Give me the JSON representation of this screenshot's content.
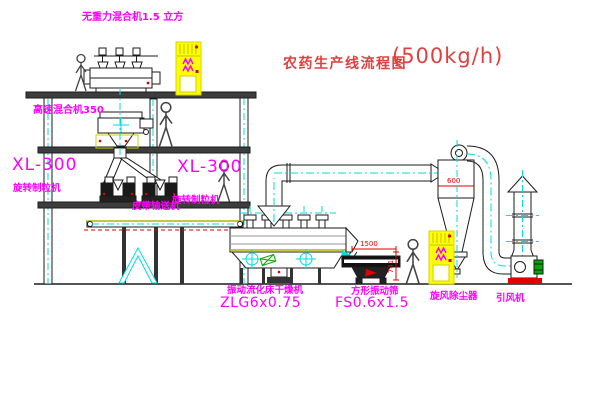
{
  "title": {
    "name": "农药生产线流程图",
    "capacity": "(500kg/h)"
  },
  "labels": {
    "top_mixer": "无重力混合机1.5 立方",
    "high_speed_mixer": "高速混合机350",
    "granulator_left_model": "XL-300",
    "granulator_left_name": "旋转制粒机",
    "granulator_right_model": "XL-300",
    "granulator_right_name": "旋转制粒机",
    "belt_conveyor": "皮带输送机",
    "dryer_name": "振动流化床干燥机",
    "dryer_model": "ZLG6x0.75",
    "sieve_name": "方形振动筛",
    "sieve_model": "FS0.6x1.5",
    "cyclone": "旋风除尘器",
    "fan": "引风机"
  },
  "dimensions": {
    "sieve_length": "1500",
    "sieve_height": "741",
    "cyclone_diameter": "600"
  },
  "colors": {
    "label_magenta": "#FF00FF",
    "title_red": "#E04040",
    "centerline_cyan": "#00DEDE",
    "cabinet_yellow": "#FFFF00",
    "motor_green": "#00A800",
    "dimension_red": "#E00000",
    "deck_olive": "#B4B400",
    "line_black": "#1B1B1B"
  },
  "figures": {
    "person_count": 4
  }
}
